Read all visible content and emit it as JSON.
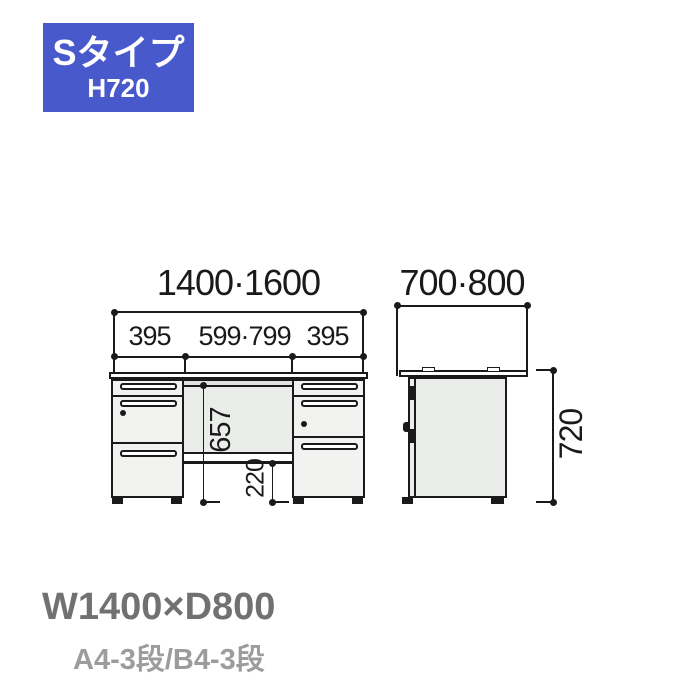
{
  "badge": {
    "type_label": "Sタイプ",
    "height_label": "H720"
  },
  "front_view": {
    "dim_width_total": "1400·1600",
    "dim_width_left_pedestal": "395",
    "dim_width_center": "599·799",
    "dim_width_right_pedestal": "395",
    "dim_height_under_top": "657",
    "dim_height_clearance": "220"
  },
  "side_view": {
    "dim_depth_total": "700·800",
    "dim_height_total": "720"
  },
  "footer": {
    "size_label": "W1400×D800",
    "drawer_config_label": "A4-3段/B4-3段"
  },
  "colors": {
    "badge_bg": "#4859cb",
    "line_ink": "#1a1a1a",
    "panel_fill": "#ebedeb",
    "drawer_fill": "#f2f3f1",
    "footer_primary": "#717171",
    "footer_secondary": "#9c9c9c"
  }
}
